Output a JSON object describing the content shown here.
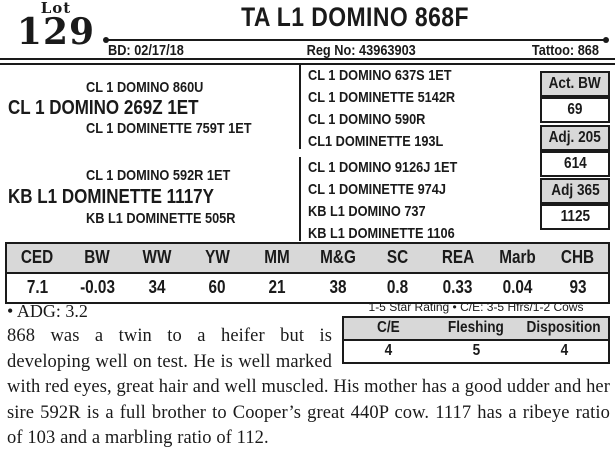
{
  "header": {
    "lot_label": "Lot",
    "lot_number": "129",
    "title": "TA L1 DOMINO 868F",
    "birth_date": "BD: 02/17/18",
    "reg_no": "Reg No: 43963903",
    "tattoo": "Tattoo: 868"
  },
  "pedigree": {
    "sire_line": {
      "grandsire": "CL 1 DOMINO 860U",
      "sire": "CL 1 DOMINO 269Z 1ET",
      "granddam": "CL 1 DOMINETTE 759T 1ET"
    },
    "dam_line": {
      "grandsire": "CL 1 DOMINO 592R 1ET",
      "dam": "KB L1 DOMINETTE 1117Y",
      "granddam": "KB L1 DOMINETTE 505R"
    },
    "great_grandparents": [
      "CL 1 DOMINO 637S 1ET",
      "CL 1 DOMINETTE 5142R",
      "CL 1 DOMINO 590R",
      "CL1 DOMINETTE 193L",
      "CL 1 DOMINO 9126J 1ET",
      "CL 1 DOMINETTE 974J",
      "KB L1 DOMINO 737",
      "KB L1 DOMINETTE 1106"
    ]
  },
  "weights": [
    {
      "label": "Act. BW",
      "value": "69"
    },
    {
      "label": "Adj. 205",
      "value": "614"
    },
    {
      "label": "Adj 365",
      "value": "1125"
    }
  ],
  "epd": {
    "headers": [
      "CED",
      "BW",
      "WW",
      "YW",
      "MM",
      "M&G",
      "SC",
      "REA",
      "Marb",
      "CHB"
    ],
    "values": [
      "7.1",
      "-0.03",
      "34",
      "60",
      "21",
      "38",
      "0.8",
      "0.33",
      "0.04",
      "93"
    ]
  },
  "star_rating": {
    "caption": "1-5 Star Rating • C/E: 3-5 Hfrs/1-2 Cows",
    "headers": [
      "C/E",
      "Fleshing",
      "Disposition"
    ],
    "values": [
      "4",
      "5",
      "4"
    ]
  },
  "notes": {
    "bullet": "•",
    "adg": "ADG: 3.2",
    "description": "868 was a twin to a heifer but is developing well on test. He is well marked with red eyes, great hair and well muscled. His mother has a good udder and her sire 592R is a full brother to Cooper’s great 440P cow. 1117 has a ribeye ratio of 103 and a marbling ratio of 112."
  },
  "colors": {
    "header_fill": "#d8d8d8",
    "ink": "#1a1a1a"
  }
}
